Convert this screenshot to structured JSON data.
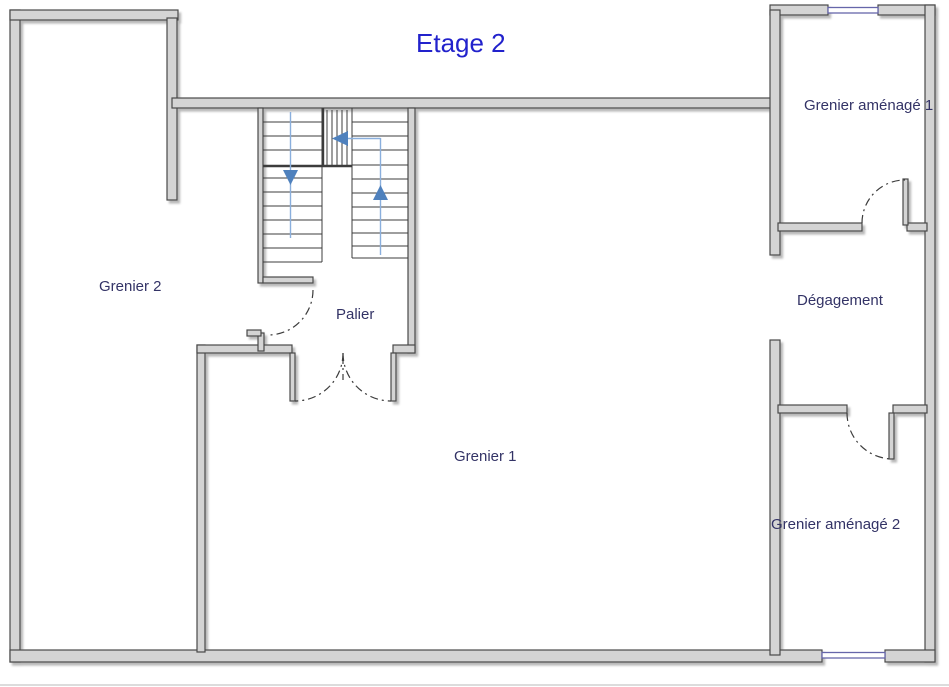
{
  "title": "Etage 2",
  "rooms": [
    {
      "id": "grenier-2",
      "label": "Grenier 2"
    },
    {
      "id": "palier",
      "label": "Palier"
    },
    {
      "id": "grenier-1",
      "label": "Grenier 1"
    },
    {
      "id": "grenier-amenage-1",
      "label": "Grenier aménagé 1"
    },
    {
      "id": "degagement",
      "label": "Dégagement"
    },
    {
      "id": "grenier-amenage-2",
      "label": "Grenier aménagé 2"
    }
  ],
  "stairs": {
    "flights": [
      "left-flight-down",
      "winder-top",
      "right-flight-up"
    ],
    "direction_arrows": [
      "down",
      "left",
      "up"
    ]
  },
  "doors": [
    {
      "id": "door-grenier2-palier"
    },
    {
      "id": "double-door-palier-grenier1"
    },
    {
      "id": "door-degagement-grenier-amenage-1"
    },
    {
      "id": "door-degagement-grenier-amenage-2"
    }
  ],
  "windows": [
    {
      "id": "window-grenier-amenage-1-top"
    },
    {
      "id": "window-grenier-amenage-2-bottom"
    }
  ],
  "colors": {
    "title": "#2222cc",
    "room_label": "#333366",
    "wall_fill": "#d4d4d4",
    "wall_outline": "#4a4a4a",
    "stair_line": "#3c3c3c",
    "arrow_blue": "#4f81bd",
    "guide_blue": "#8aafdd",
    "window_blue": "#6666aa"
  }
}
